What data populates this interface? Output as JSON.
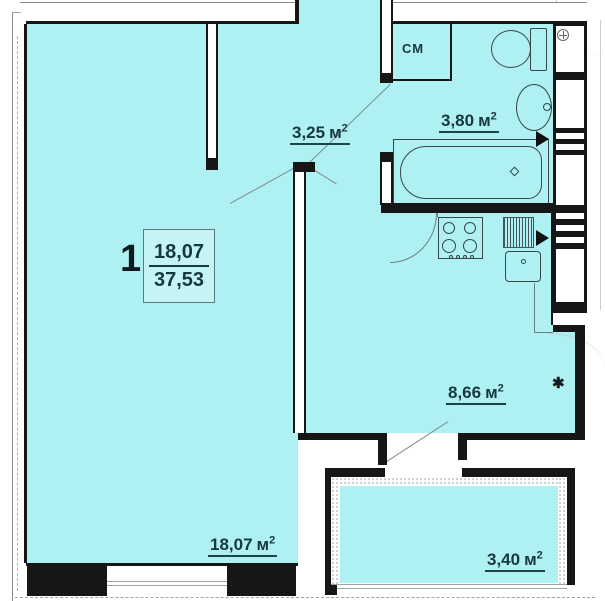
{
  "unit": {
    "number": "1",
    "living_area": "18,07",
    "total_area": "37,53"
  },
  "rooms": [
    {
      "name": "hallway",
      "area": "3,25",
      "unit": "м",
      "sup": "2"
    },
    {
      "name": "bathroom",
      "area": "3,80",
      "unit": "м",
      "sup": "2"
    },
    {
      "name": "kitchen",
      "area": "8,66",
      "unit": "м",
      "sup": "2"
    },
    {
      "name": "living-room",
      "area": "18,07",
      "unit": "м",
      "sup": "2"
    },
    {
      "name": "balcony",
      "area": "3,40",
      "unit": "м",
      "sup": "2"
    }
  ],
  "annotations": {
    "washing_machine": "СМ",
    "star": "✱"
  },
  "colors": {
    "floor_fill": "#aff0f2",
    "wall": "#161616",
    "label_text": "#16383f"
  }
}
